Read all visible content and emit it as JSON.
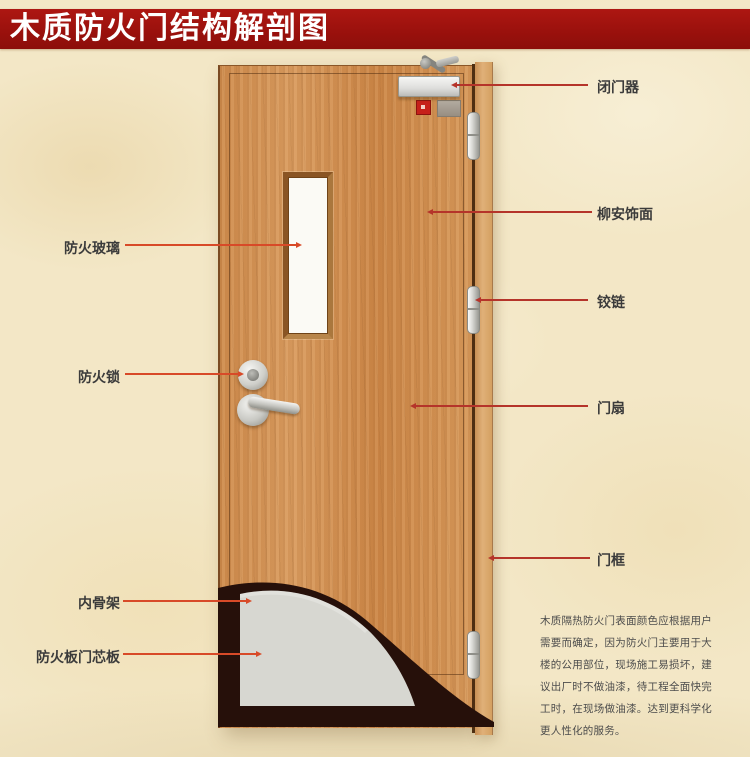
{
  "title": "木质防火门结构解剖图",
  "labels_left": [
    {
      "text": "防火玻璃",
      "target": "fire-glass"
    },
    {
      "text": "防火锁",
      "target": "fire-lock"
    },
    {
      "text": "内骨架",
      "target": "inner-skeleton"
    },
    {
      "text": "防火板门芯板",
      "target": "fireproof-core-panel"
    }
  ],
  "labels_right": [
    {
      "text": "闭门器",
      "target": "door-closer"
    },
    {
      "text": "柳安饰面",
      "target": "lauan-veneer"
    },
    {
      "text": "铰链",
      "target": "hinge"
    },
    {
      "text": "门扇",
      "target": "door-leaf"
    },
    {
      "text": "门框",
      "target": "door-frame"
    }
  ],
  "description": "木质隔热防火门表面颜色应根据用户需要而确定，因为防火门主要用于大楼的公用部位，现场施工易损坏，建议出厂时不做油漆，待工程全面快完工时，在现场做油漆。达到更科学化更人性化的服务。",
  "colors": {
    "title_bar": "#9b110d",
    "title_text": "#ffffff",
    "leader_left": "#d84a28",
    "leader_right": "#b5342a",
    "door_wood": "#d08c4e",
    "frame_wood": "#dcab72",
    "core_panel": "#d7d7d1",
    "skeleton_dark": "#26100a",
    "background": "#f3e7c6"
  }
}
